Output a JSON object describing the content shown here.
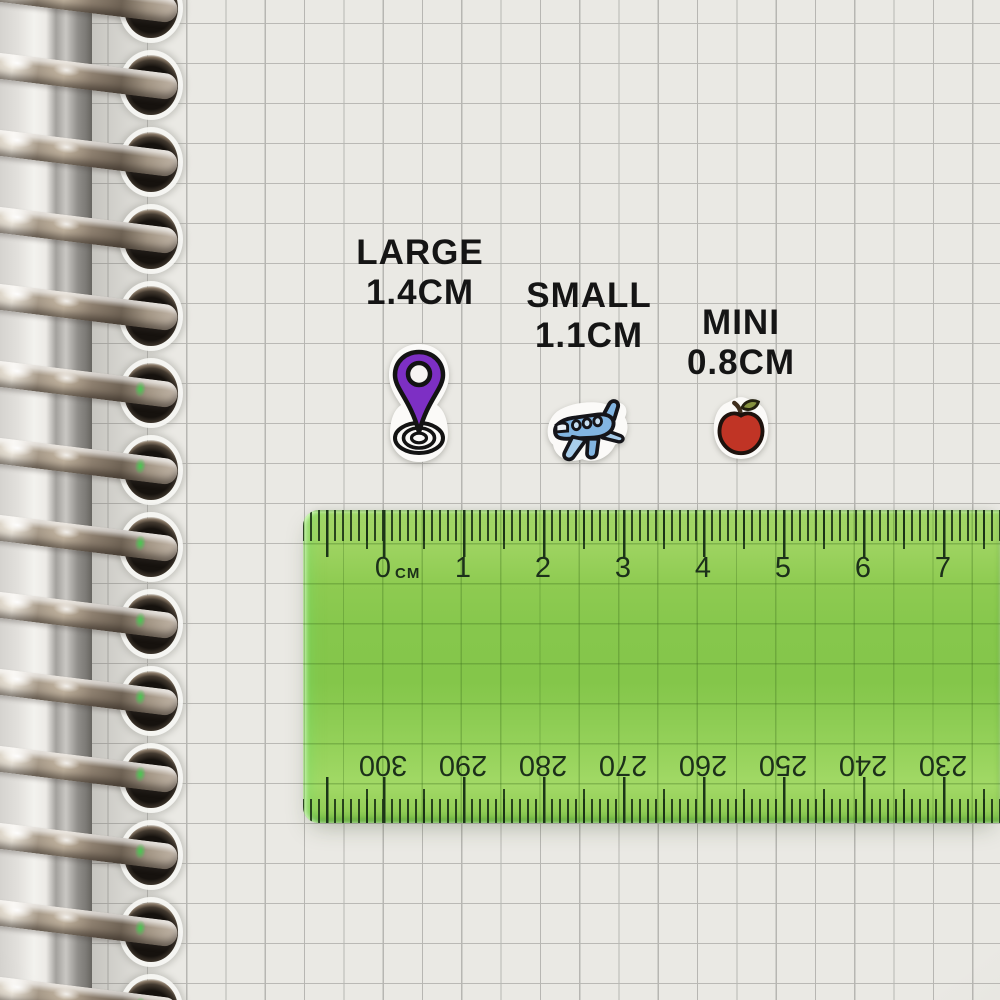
{
  "scene": {
    "paper_color": "#eae9e4",
    "grid_color": "#b7b6b2",
    "binding": "silver-spiral-rings"
  },
  "size_labels": [
    {
      "title": "LARGE",
      "size": "1.4CM"
    },
    {
      "title": "SMALL",
      "size": "1.1CM"
    },
    {
      "title": "MINI",
      "size": "0.8CM"
    }
  ],
  "stickers": [
    {
      "icon": "location-pin-icon",
      "size_label": "LARGE",
      "size": "1.4CM",
      "color": "#7d2fc4"
    },
    {
      "icon": "airplane-icon",
      "size_label": "SMALL",
      "size": "1.1CM",
      "color": "#82b5e2"
    },
    {
      "icon": "apple-icon",
      "size_label": "MINI",
      "size": "0.8CM",
      "color": "#c03425"
    }
  ],
  "ruler": {
    "unit": "CM",
    "top_numbers": [
      "0",
      "1",
      "2",
      "3",
      "4",
      "5",
      "6",
      "7"
    ],
    "bottom_numbers": [
      "300",
      "290",
      "280",
      "270",
      "260",
      "250",
      "240",
      "230"
    ],
    "body_color": "#8cc952",
    "tick_color": "#1c3518"
  }
}
